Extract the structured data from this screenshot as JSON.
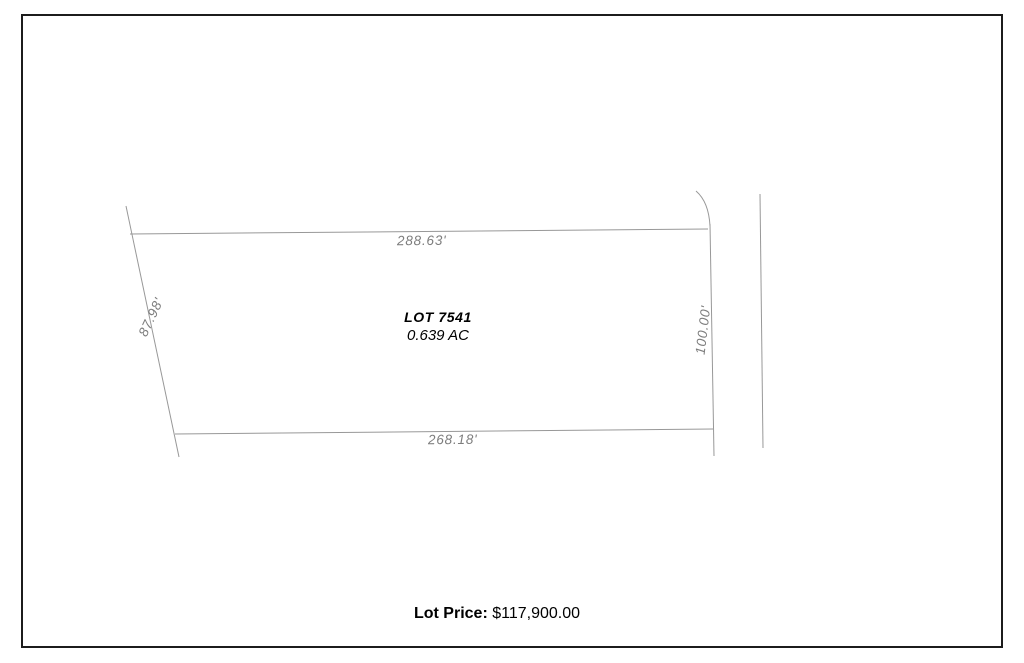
{
  "document": {
    "kind": "lot-survey-plat"
  },
  "lot": {
    "name": "LOT 7541",
    "area": "0.639 AC",
    "dimensions": {
      "north": "288.63'",
      "south": "268.18'",
      "west": "87.98'",
      "east": "100.00'"
    }
  },
  "price": {
    "label": "Lot Price:",
    "value": "$117,900.00"
  },
  "colors": {
    "boundary_line": "#989898",
    "dimension_text": "#7d7d7d",
    "page_border": "#1c1c1c",
    "primary_text": "#000000",
    "background": "#ffffff"
  }
}
